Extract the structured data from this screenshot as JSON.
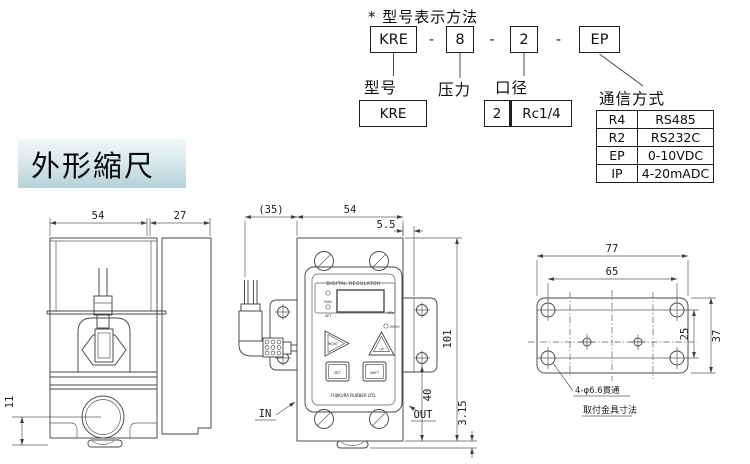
{
  "model": {
    "title": "* 型号表示方法",
    "sep": "-",
    "codes": {
      "model": "KRE",
      "pressure": "8",
      "bore": "2",
      "comm": "EP"
    },
    "labels": {
      "model": "型号",
      "pressure": "压力",
      "bore": "口径",
      "comm": "通信方式"
    },
    "model_value": "KRE",
    "bore_value": {
      "code": "2",
      "size": "Rc1/4"
    },
    "comm_options": [
      {
        "code": "R4",
        "name": "RS485"
      },
      {
        "code": "R2",
        "name": "RS232C"
      },
      {
        "code": "EP",
        "name": "0-10VDC"
      },
      {
        "code": "IP",
        "name": "4-20mADC"
      }
    ]
  },
  "heading": "外形縮尺",
  "side_view": {
    "dim_width": "54",
    "dim_depth": "27",
    "dim_port_height": "11"
  },
  "front_view": {
    "dim_ref_depth": "(35)",
    "dim_width": "54",
    "dim_offset": "5.5",
    "dim_height": "101",
    "dim_out_height": "40",
    "dim_tab": "3.15",
    "label_in": "IN",
    "label_out": "OUT",
    "panel": {
      "title": "DIGITAL REGULATOR",
      "led_run": "RUN",
      "led_set": "SET",
      "unit": "MPa",
      "zero": "ZERO",
      "btn_right": "RIGHT",
      "btn_up": "UP",
      "btn_set": "SET",
      "btn_shift": "SHIFT",
      "brand": "FUJIKURA RUBBER LTD."
    }
  },
  "bracket_view": {
    "dim_width": "77",
    "dim_hole_span": "65",
    "dim_height": "37",
    "dim_hole_span_v": "25",
    "hole_note": "4-φ6.6貫通",
    "caption": "取付金具寸法"
  }
}
